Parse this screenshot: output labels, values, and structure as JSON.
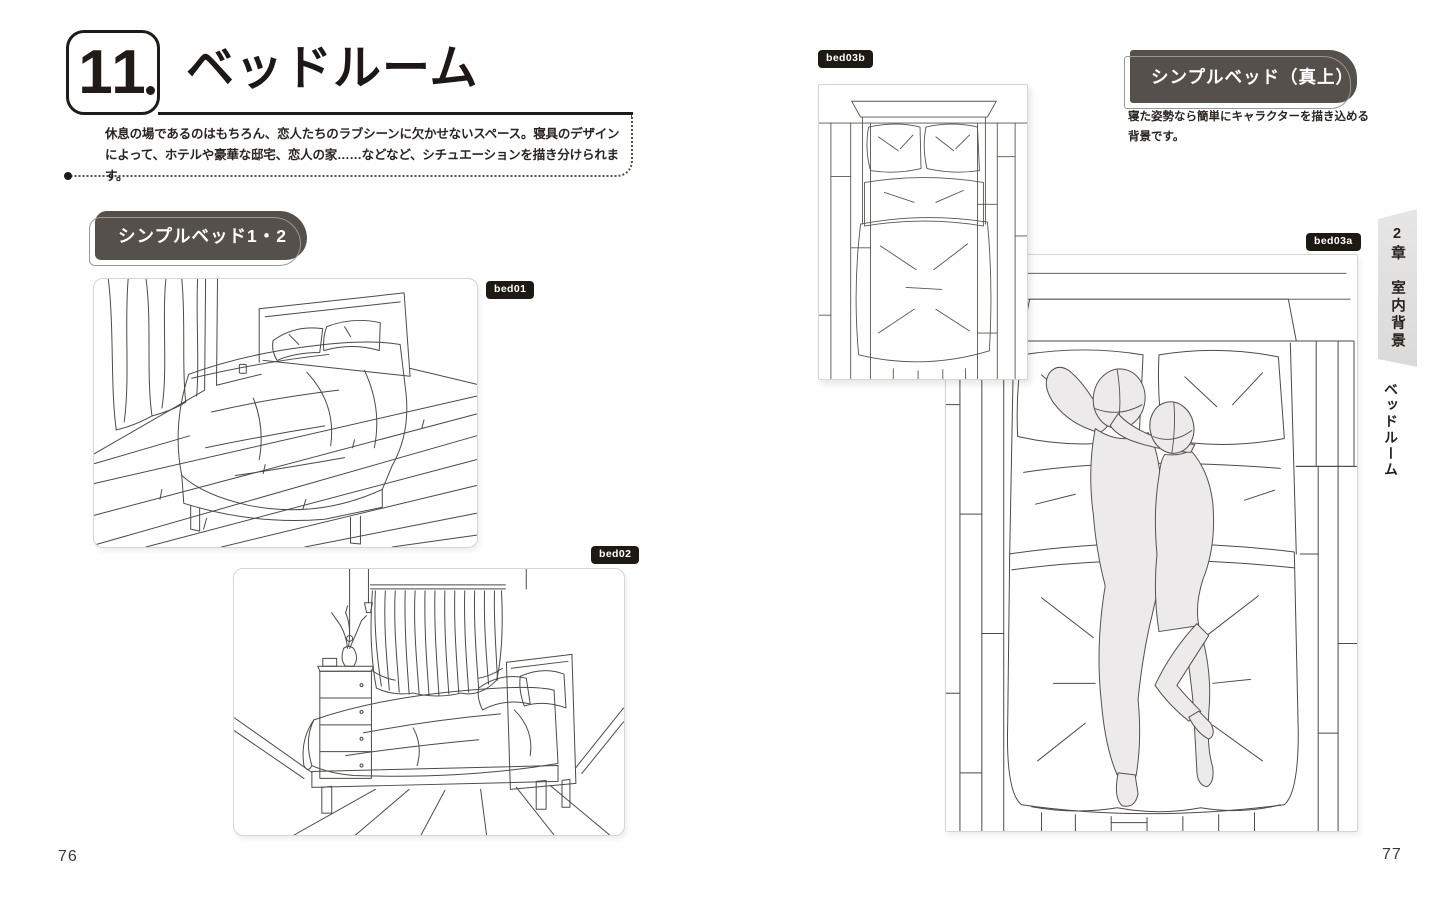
{
  "header": {
    "chapter_number": "11",
    "title": "ベッドルーム",
    "intro_lines": [
      "休息の場であるのはもちろん、恋人たちのラブシーンに欠かせないスペース。寝具のデザイン",
      "によって、ホテルや豪華な邸宅、恋人の家……などなど、シチュエーションを描き分けられます。"
    ]
  },
  "left_page": {
    "section_label": "シンプルベッド1・2",
    "figures": [
      {
        "badge": "bed01",
        "subject": "perspective view of double bed on plank floor with curtains"
      },
      {
        "badge": "bed02",
        "subject": "side view of bed with curtain, dresser and pendant lights"
      }
    ],
    "page_number": "76"
  },
  "right_page": {
    "section_label": "シンプルベッド（真上）",
    "caption_lines": [
      "寝た姿勢なら簡単にキャラクターを描き込める",
      "背景です。"
    ],
    "figures": [
      {
        "badge": "bed03b",
        "subject": "top-down view of empty bed"
      },
      {
        "badge": "bed03a",
        "subject": "top-down view of bed with two mannequin figures"
      }
    ],
    "page_number": "77"
  },
  "side_tab": {
    "chapter_label": "2章　室内背景",
    "section_label": "ベッドルーム"
  },
  "colors": {
    "ink": "#211b17",
    "section_label_bg": "#56504d",
    "badge_bg": "#1f1914",
    "tab_bg": "#e2e0de",
    "panel_border": "#d7d4d1"
  }
}
